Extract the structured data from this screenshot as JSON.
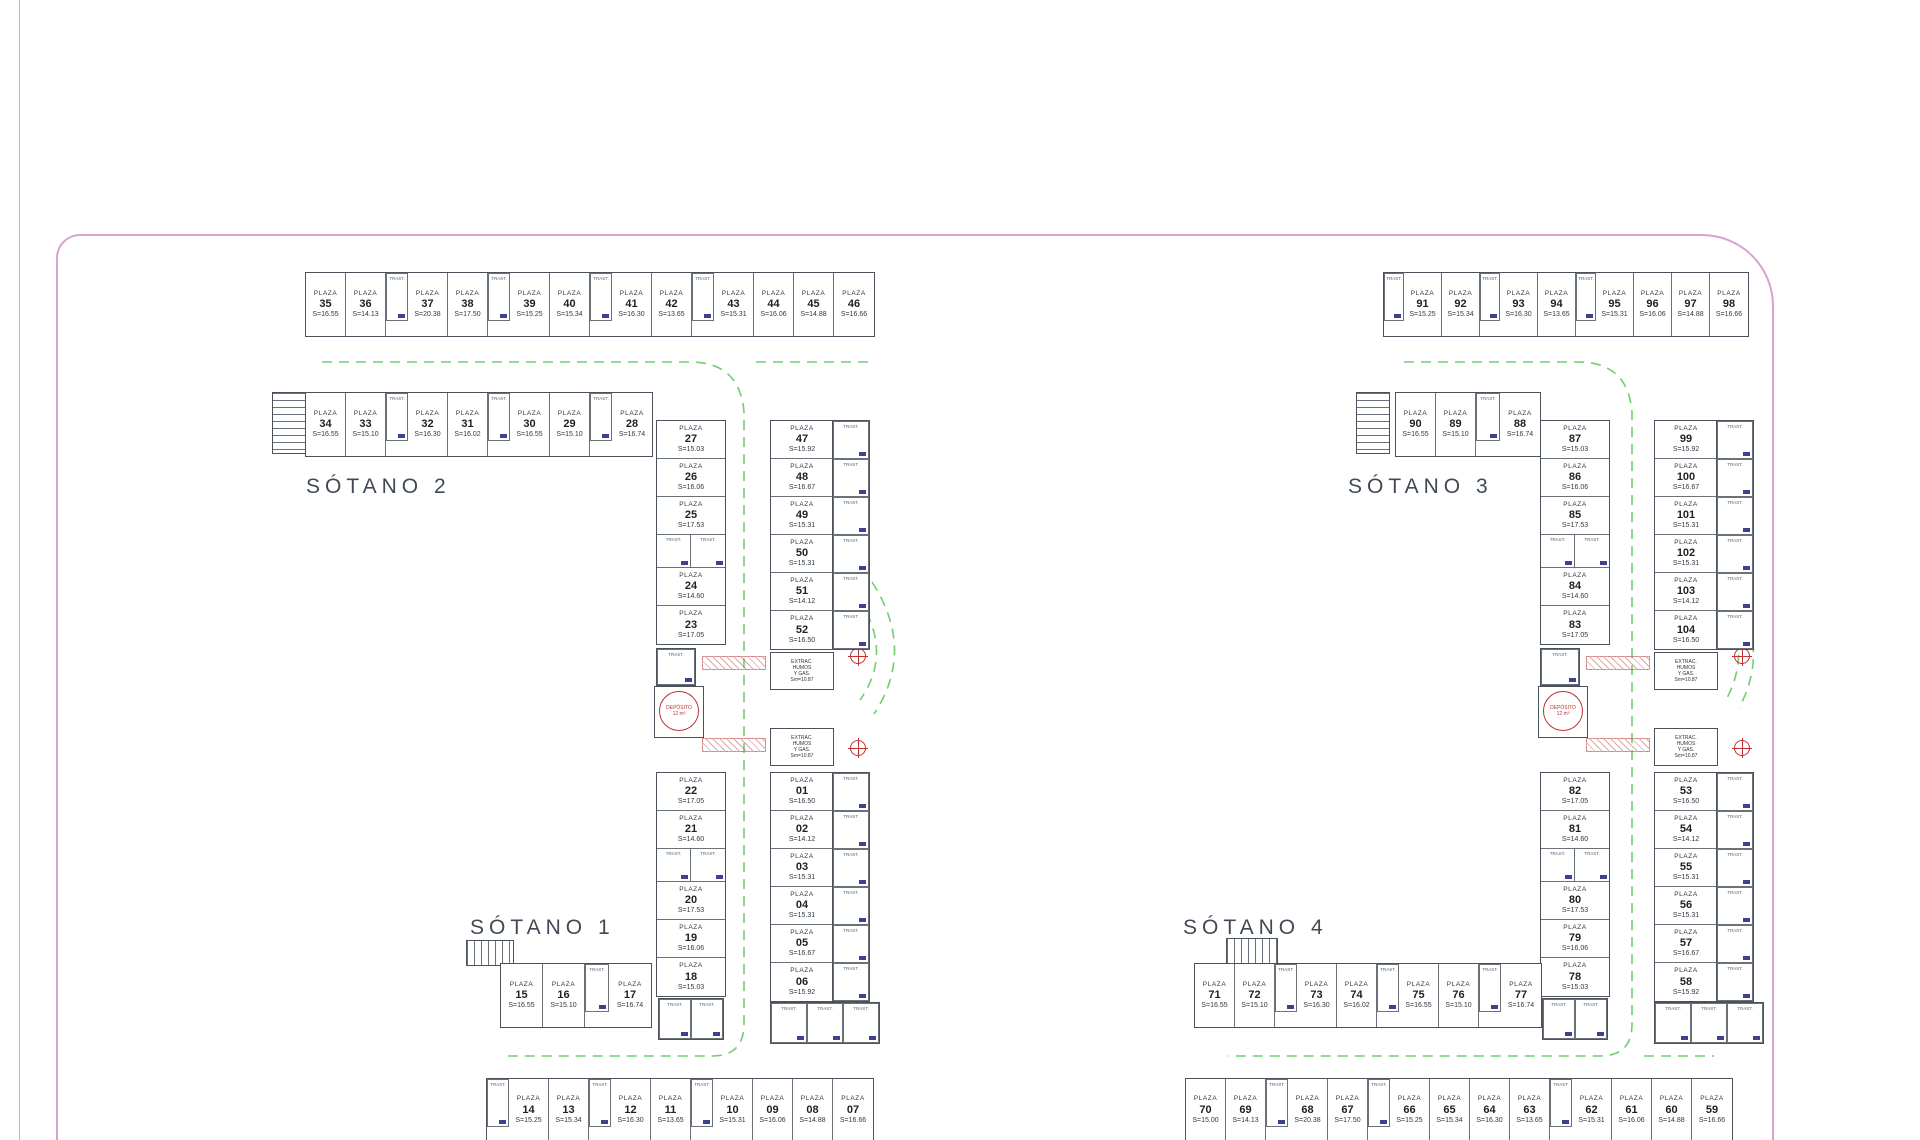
{
  "plan": {
    "border_color": "#d9a2d0",
    "lane_color": "#62c862",
    "wall_color": "#4b525b",
    "accent_navy": "#3d418f",
    "accent_red": "#c03030"
  },
  "labels": {
    "sotano1": "SÓTANO 1",
    "sotano2": "SÓTANO 2",
    "sotano3": "SÓTANO 3",
    "sotano4": "SÓTANO 4"
  },
  "misc": {
    "plaza_word": "PLAZA",
    "trast_word": "TRAST.",
    "extract_lines": [
      "EXTRAC.",
      "HUMOS",
      "Y GAS.",
      "Sm=10.87"
    ],
    "deposito_line1": "DEPÓSITO",
    "deposito_line2": "12 m³"
  },
  "stall_groups": [
    {
      "name": "s2-top-row",
      "dir": "h",
      "x": 305,
      "y": 272,
      "pw": 40,
      "ph": 63,
      "tw": 22,
      "th": 48,
      "items": [
        [
          "p",
          "35",
          "S=16.55"
        ],
        [
          "p",
          "36",
          "S=14.13"
        ],
        [
          "t"
        ],
        [
          "p",
          "37",
          "S=20.38"
        ],
        [
          "p",
          "38",
          "S=17.50"
        ],
        [
          "t"
        ],
        [
          "p",
          "39",
          "S=15.25"
        ],
        [
          "p",
          "40",
          "S=15.34"
        ],
        [
          "t"
        ],
        [
          "p",
          "41",
          "S=16.30"
        ],
        [
          "p",
          "42",
          "S=13.65"
        ],
        [
          "t"
        ],
        [
          "p",
          "43",
          "S=15.31"
        ],
        [
          "p",
          "44",
          "S=16.06"
        ],
        [
          "p",
          "45",
          "S=14.88"
        ],
        [
          "p",
          "46",
          "S=16.66"
        ]
      ]
    },
    {
      "name": "s2-second-row",
      "dir": "h",
      "x": 305,
      "y": 392,
      "pw": 40,
      "ph": 63,
      "tw": 22,
      "th": 48,
      "items": [
        [
          "p",
          "34",
          "S=16.55"
        ],
        [
          "p",
          "33",
          "S=15.10"
        ],
        [
          "t"
        ],
        [
          "p",
          "32",
          "S=16.30"
        ],
        [
          "p",
          "31",
          "S=16.02"
        ],
        [
          "t"
        ],
        [
          "p",
          "30",
          "S=16.55"
        ],
        [
          "p",
          "29",
          "S=15.10"
        ],
        [
          "t"
        ],
        [
          "p",
          "28",
          "S=16.74"
        ]
      ]
    },
    {
      "name": "s2-col-inner",
      "dir": "v",
      "x": 656,
      "y": 420,
      "pw": 68,
      "ph": 38,
      "th": 33,
      "items": [
        [
          "p",
          "27",
          "S=15.03"
        ],
        [
          "p",
          "26",
          "S=16.06"
        ],
        [
          "p",
          "25",
          "S=17.53"
        ],
        [
          "tt"
        ],
        [
          "p",
          "24",
          "S=14.60"
        ],
        [
          "p",
          "23",
          "S=17.05"
        ]
      ]
    },
    {
      "name": "s1-col-inner",
      "dir": "v",
      "x": 656,
      "y": 772,
      "pw": 68,
      "ph": 38,
      "th": 33,
      "items": [
        [
          "p",
          "22",
          "S=17.05"
        ],
        [
          "p",
          "21",
          "S=14.60"
        ],
        [
          "tt"
        ],
        [
          "p",
          "20",
          "S=17.53"
        ],
        [
          "p",
          "19",
          "S=16.06"
        ],
        [
          "p",
          "18",
          "S=15.03"
        ]
      ]
    },
    {
      "name": "s2-col-outer",
      "dir": "v",
      "x": 770,
      "y": 420,
      "pw": 62,
      "ph": 38,
      "th": 33,
      "items": [
        [
          "p",
          "47",
          "S=15.92"
        ],
        [
          "p",
          "48",
          "S=16.67"
        ],
        [
          "p",
          "49",
          "S=15.31"
        ],
        [
          "p",
          "50",
          "S=15.31"
        ],
        [
          "p",
          "51",
          "S=14.12"
        ],
        [
          "p",
          "52",
          "S=16.50"
        ]
      ]
    },
    {
      "name": "s2-trast-col",
      "dir": "v",
      "x": 832,
      "y": 420,
      "pw": 36,
      "ph": 38,
      "th": 38,
      "items": [
        [
          "t"
        ],
        [
          "t"
        ],
        [
          "t"
        ],
        [
          "t"
        ],
        [
          "t"
        ],
        [
          "t"
        ]
      ]
    },
    {
      "name": "s1-col-outer",
      "dir": "v",
      "x": 770,
      "y": 772,
      "pw": 62,
      "ph": 38,
      "th": 33,
      "items": [
        [
          "p",
          "01",
          "S=16.50"
        ],
        [
          "p",
          "02",
          "S=14.12"
        ],
        [
          "p",
          "03",
          "S=15.31"
        ],
        [
          "p",
          "04",
          "S=15.31"
        ],
        [
          "p",
          "05",
          "S=16.67"
        ],
        [
          "p",
          "06",
          "S=15.92"
        ]
      ]
    },
    {
      "name": "s1-trast-col",
      "dir": "v",
      "x": 832,
      "y": 772,
      "pw": 36,
      "ph": 38,
      "th": 38,
      "items": [
        [
          "t"
        ],
        [
          "t"
        ],
        [
          "t"
        ],
        [
          "t"
        ],
        [
          "t"
        ],
        [
          "t"
        ]
      ]
    },
    {
      "name": "s2-trast-mid",
      "dir": "h",
      "x": 656,
      "y": 648,
      "pw": 38,
      "ph": 36,
      "tw": 38,
      "th": 36,
      "items": [
        [
          "t"
        ]
      ]
    },
    {
      "name": "s1-trast-under-inner",
      "dir": "h",
      "x": 658,
      "y": 998,
      "pw": 32,
      "ph": 40,
      "tw": 32,
      "th": 40,
      "items": [
        [
          "t"
        ],
        [
          "t"
        ]
      ]
    },
    {
      "name": "s1-trast-under-outer",
      "dir": "h",
      "x": 770,
      "y": 1002,
      "pw": 36,
      "ph": 40,
      "tw": 36,
      "th": 40,
      "items": [
        [
          "t"
        ],
        [
          "t"
        ],
        [
          "t"
        ]
      ]
    },
    {
      "name": "s1-row-15-17",
      "dir": "h",
      "x": 500,
      "y": 963,
      "pw": 42,
      "ph": 63,
      "tw": 24,
      "th": 48,
      "items": [
        [
          "p",
          "15",
          "S=16.55"
        ],
        [
          "p",
          "16",
          "S=15.10"
        ],
        [
          "t"
        ],
        [
          "p",
          "17",
          "S=16.74"
        ]
      ]
    },
    {
      "name": "s1-bottom-row",
      "dir": "h",
      "x": 486,
      "y": 1078,
      "pw": 40,
      "ph": 62,
      "tw": 22,
      "th": 48,
      "items": [
        [
          "t"
        ],
        [
          "p",
          "14",
          "S=15.25"
        ],
        [
          "p",
          "13",
          "S=15.34"
        ],
        [
          "t"
        ],
        [
          "p",
          "12",
          "S=16.30"
        ],
        [
          "p",
          "11",
          "S=13.65"
        ],
        [
          "t"
        ],
        [
          "p",
          "10",
          "S=15.31"
        ],
        [
          "p",
          "09",
          "S=16.06"
        ],
        [
          "p",
          "08",
          "S=14.88"
        ],
        [
          "p",
          "07",
          "S=16.66"
        ]
      ]
    },
    {
      "name": "s3-top-row",
      "dir": "h",
      "x": 1383,
      "y": 272,
      "pw": 38,
      "ph": 63,
      "tw": 20,
      "th": 48,
      "items": [
        [
          "t"
        ],
        [
          "p",
          "91",
          "S=15.25"
        ],
        [
          "p",
          "92",
          "S=15.34"
        ],
        [
          "t"
        ],
        [
          "p",
          "93",
          "S=16.30"
        ],
        [
          "p",
          "94",
          "S=13.65"
        ],
        [
          "t"
        ],
        [
          "p",
          "95",
          "S=15.31"
        ],
        [
          "p",
          "96",
          "S=16.06"
        ],
        [
          "p",
          "97",
          "S=14.88"
        ],
        [
          "p",
          "98",
          "S=16.66"
        ]
      ]
    },
    {
      "name": "s3-second-row",
      "dir": "h",
      "x": 1395,
      "y": 392,
      "pw": 40,
      "ph": 63,
      "tw": 24,
      "th": 48,
      "items": [
        [
          "p",
          "90",
          "S=16.55"
        ],
        [
          "p",
          "89",
          "S=15.10"
        ],
        [
          "t"
        ],
        [
          "p",
          "88",
          "S=16.74"
        ]
      ]
    },
    {
      "name": "s3-col-inner",
      "dir": "v",
      "x": 1540,
      "y": 420,
      "pw": 68,
      "ph": 38,
      "th": 33,
      "items": [
        [
          "p",
          "87",
          "S=15.03"
        ],
        [
          "p",
          "86",
          "S=16.06"
        ],
        [
          "p",
          "85",
          "S=17.53"
        ],
        [
          "tt"
        ],
        [
          "p",
          "84",
          "S=14.60"
        ],
        [
          "p",
          "83",
          "S=17.05"
        ]
      ]
    },
    {
      "name": "s4-col-inner",
      "dir": "v",
      "x": 1540,
      "y": 772,
      "pw": 68,
      "ph": 38,
      "th": 33,
      "items": [
        [
          "p",
          "82",
          "S=17.05"
        ],
        [
          "p",
          "81",
          "S=14.60"
        ],
        [
          "tt"
        ],
        [
          "p",
          "80",
          "S=17.53"
        ],
        [
          "p",
          "79",
          "S=16.06"
        ],
        [
          "p",
          "78",
          "S=15.03"
        ]
      ]
    },
    {
      "name": "s3-col-outer",
      "dir": "v",
      "x": 1654,
      "y": 420,
      "pw": 62,
      "ph": 38,
      "th": 33,
      "items": [
        [
          "p",
          "99",
          "S=15.92"
        ],
        [
          "p",
          "100",
          "S=16.67"
        ],
        [
          "p",
          "101",
          "S=15.31"
        ],
        [
          "p",
          "102",
          "S=15.31"
        ],
        [
          "p",
          "103",
          "S=14.12"
        ],
        [
          "p",
          "104",
          "S=16.50"
        ]
      ]
    },
    {
      "name": "s3-trast-col",
      "dir": "v",
      "x": 1716,
      "y": 420,
      "pw": 36,
      "ph": 38,
      "th": 38,
      "items": [
        [
          "t"
        ],
        [
          "t"
        ],
        [
          "t"
        ],
        [
          "t"
        ],
        [
          "t"
        ],
        [
          "t"
        ]
      ]
    },
    {
      "name": "s4-col-outer",
      "dir": "v",
      "x": 1654,
      "y": 772,
      "pw": 62,
      "ph": 38,
      "th": 33,
      "items": [
        [
          "p",
          "53",
          "S=16.50"
        ],
        [
          "p",
          "54",
          "S=14.12"
        ],
        [
          "p",
          "55",
          "S=15.31"
        ],
        [
          "p",
          "56",
          "S=15.31"
        ],
        [
          "p",
          "57",
          "S=16.67"
        ],
        [
          "p",
          "58",
          "S=15.92"
        ]
      ]
    },
    {
      "name": "s4-trast-col",
      "dir": "v",
      "x": 1716,
      "y": 772,
      "pw": 36,
      "ph": 38,
      "th": 38,
      "items": [
        [
          "t"
        ],
        [
          "t"
        ],
        [
          "t"
        ],
        [
          "t"
        ],
        [
          "t"
        ],
        [
          "t"
        ]
      ]
    },
    {
      "name": "s3-trast-mid",
      "dir": "h",
      "x": 1540,
      "y": 648,
      "pw": 38,
      "ph": 36,
      "tw": 38,
      "th": 36,
      "items": [
        [
          "t"
        ]
      ]
    },
    {
      "name": "s4-trast-under-inner",
      "dir": "h",
      "x": 1542,
      "y": 998,
      "pw": 32,
      "ph": 40,
      "tw": 32,
      "th": 40,
      "items": [
        [
          "t"
        ],
        [
          "t"
        ]
      ]
    },
    {
      "name": "s4-trast-under-outer",
      "dir": "h",
      "x": 1654,
      "y": 1002,
      "pw": 36,
      "ph": 40,
      "tw": 36,
      "th": 40,
      "items": [
        [
          "t"
        ],
        [
          "t"
        ],
        [
          "t"
        ]
      ]
    },
    {
      "name": "s4-row-71-77",
      "dir": "h",
      "x": 1194,
      "y": 963,
      "pw": 40,
      "ph": 63,
      "tw": 22,
      "th": 48,
      "items": [
        [
          "p",
          "71",
          "S=16.55"
        ],
        [
          "p",
          "72",
          "S=15.10"
        ],
        [
          "t"
        ],
        [
          "p",
          "73",
          "S=16.30"
        ],
        [
          "p",
          "74",
          "S=16.02"
        ],
        [
          "t"
        ],
        [
          "p",
          "75",
          "S=16.55"
        ],
        [
          "p",
          "76",
          "S=15.10"
        ],
        [
          "t"
        ],
        [
          "p",
          "77",
          "S=16.74"
        ]
      ]
    },
    {
      "name": "s4-bottom-row",
      "dir": "h",
      "x": 1185,
      "y": 1078,
      "pw": 40,
      "ph": 62,
      "tw": 22,
      "th": 48,
      "items": [
        [
          "p",
          "70",
          "S=15.00"
        ],
        [
          "p",
          "69",
          "S=14.13"
        ],
        [
          "t"
        ],
        [
          "p",
          "68",
          "S=20.38"
        ],
        [
          "p",
          "67",
          "S=17.50"
        ],
        [
          "t"
        ],
        [
          "p",
          "66",
          "S=15.25"
        ],
        [
          "p",
          "65",
          "S=15.34"
        ],
        [
          "p",
          "64",
          "S=16.30"
        ],
        [
          "p",
          "63",
          "S=13.65"
        ],
        [
          "t"
        ],
        [
          "p",
          "62",
          "S=15.31"
        ],
        [
          "p",
          "61",
          "S=16.06"
        ],
        [
          "p",
          "60",
          "S=14.88"
        ],
        [
          "p",
          "59",
          "S=16.66"
        ]
      ]
    }
  ]
}
